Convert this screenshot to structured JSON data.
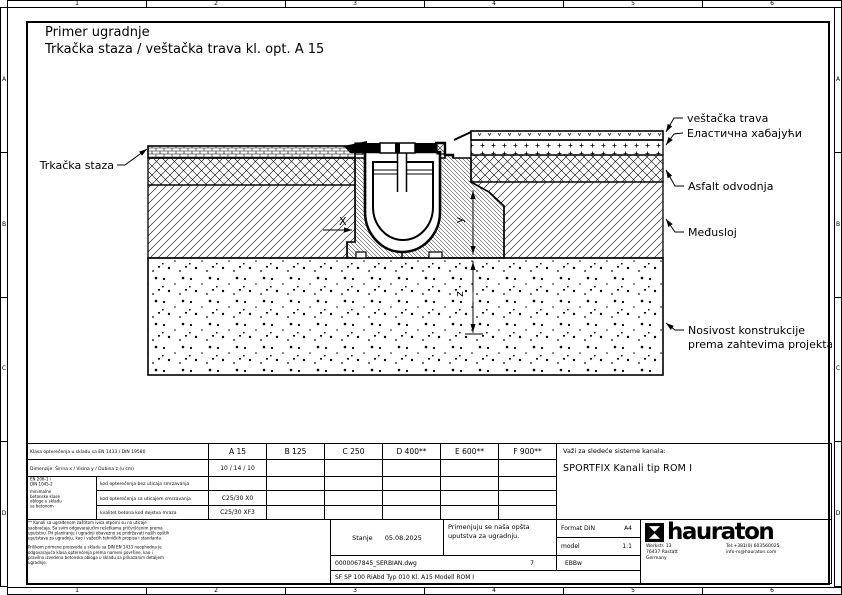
{
  "frame": {
    "ruler_cols": [
      "1",
      "2",
      "3",
      "4",
      "5",
      "6"
    ],
    "ruler_rows": [
      "A",
      "B",
      "C",
      "D"
    ]
  },
  "header": {
    "title_line1": "Primer ugradnje",
    "title_line2": "Trkačka staza / veštačka trava kl. opt. A 15"
  },
  "drawing": {
    "labels": {
      "track": "Trkačka staza",
      "turf": "veštačka trava",
      "elastic": "Еластична хабајући",
      "asphalt": "Asfalt odvodnja",
      "interlayer": "Međusloj",
      "bearing1": "Nosivost konstrukcije",
      "bearing2": "prema zahtevima projekta."
    },
    "dims": {
      "x": "X",
      "y": "y",
      "z": "z"
    }
  },
  "title_block": {
    "row_load_class": "Klasa opterećenja u skladu sa EN 1433 / DIN 19580",
    "row_dimensions": "Dimenzije: Širina x / Visina y / Dubina z (u cm)",
    "classes": [
      "A 15",
      "B 125",
      "C 250",
      "D 400**",
      "E 600**",
      "F 900**"
    ],
    "dimensions_value": "10 / 14 / 10",
    "concrete_norm": [
      "EN 206-1 i",
      "DIN 1045-2",
      "minimalne betonske klase",
      "obloge u skladu sa betonom"
    ],
    "concrete_rows": [
      {
        "label": "kod opterećenja bez uticaja smrzavanja",
        "value": ""
      },
      {
        "label": "kod opterećenja sa uticajem smrzavanja",
        "value": "C25/30 X0"
      },
      {
        "label": "kvalitet betona kod dejstva mraza",
        "value": "C25/30 XF3"
      }
    ],
    "systems_heading": "Važi za sledeće sisteme kanala:",
    "systems_value": "SPORTFIX Kanali tip ROM I",
    "notes_par1": "** Kanali sa ugrađenom zaštitom ivica otporni su na uticaje saobraćaja. Sa svim odgovarajućim rešetkama pričvršćenim prema uputstvu. Pri planiranju i ugradnji obavezno se pridržavati naših opštih uputstava za ugradnju, kao i važećih tehničkih propisa i standarda.",
    "notes_par2": "Prilikom primene proizvoda u skladu sa DIN EN 1433 neophodna je odgovarajuća klasa opterećenja prema nameni površine, kao i pravilno izvedena betonska obloga u skladu sa prikazanim detaljem ugradnje.",
    "status_label": "Stanje",
    "status_date": "05.08.2025",
    "instructions_line1": "Primenjuju se naša opšta",
    "instructions_line2": "uputstva za ugradnju.",
    "format_label": "Format DIN",
    "format_value": "A4",
    "scale_label": "model",
    "scale_value": "1:1",
    "file_name": "0000067845_SERBIAN.dwg",
    "sheet_number": "7",
    "code": "EBBw",
    "model_line": "SF   SP 100 RiAbd Typ 010 Kl. A15 Modell ROM I",
    "brand": {
      "name": "hauraton",
      "address_line1": "Werkstr. 13",
      "address_line2": "76437 Rastatt",
      "address_line3": "Germany",
      "phone": "Tel:+381(0) 603560025",
      "email": "info-rs@hauraton.com"
    }
  }
}
